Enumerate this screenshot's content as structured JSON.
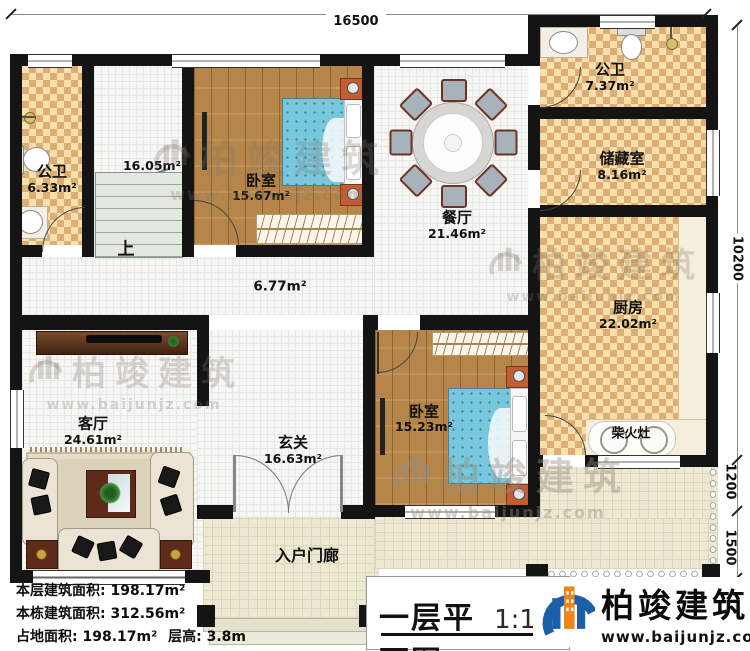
{
  "dimensions": {
    "top_width": "16500",
    "right_main": "10200",
    "right_mid": "1200",
    "right_low": "1500"
  },
  "rooms": {
    "bath1": {
      "name": "公卫",
      "area": "6.33m²"
    },
    "stairwell": {
      "area": "16.05m²",
      "up": "上"
    },
    "bedroom1": {
      "name": "卧室",
      "area": "15.67m²"
    },
    "dining": {
      "name": "餐厅",
      "area": "21.46m²"
    },
    "bath2": {
      "name": "公卫",
      "area": "7.37m²"
    },
    "storage": {
      "name": "储藏室",
      "area": "8.16m²"
    },
    "kitchen": {
      "name": "厨房",
      "area": "22.02m²"
    },
    "hall": {
      "area": "6.77m²"
    },
    "living": {
      "name": "客厅",
      "area": "24.61m²"
    },
    "foyer": {
      "name": "玄关",
      "area": "16.63m²"
    },
    "bedroom2": {
      "name": "卧室",
      "area": "15.23m²"
    },
    "stove": {
      "name": "柴火灶"
    },
    "porch": {
      "name": "入户门廊"
    }
  },
  "stats": {
    "floor_area_label": "本层建筑面积:",
    "floor_area_value": "198.17m²",
    "building_area_label": "本栋建筑面积:",
    "building_area_value": "312.56m²",
    "footprint_label": "占地面积:",
    "footprint_value": "198.17m²",
    "height_label": "层高:",
    "height_value": "3.8m"
  },
  "title": {
    "text": "一层平面图",
    "scale": "1:100"
  },
  "brand": {
    "name": "柏竣建筑",
    "website": "www.baijunjz.com"
  },
  "watermark": {
    "name": "柏竣建筑",
    "website": "www.baijunjz.com"
  }
}
